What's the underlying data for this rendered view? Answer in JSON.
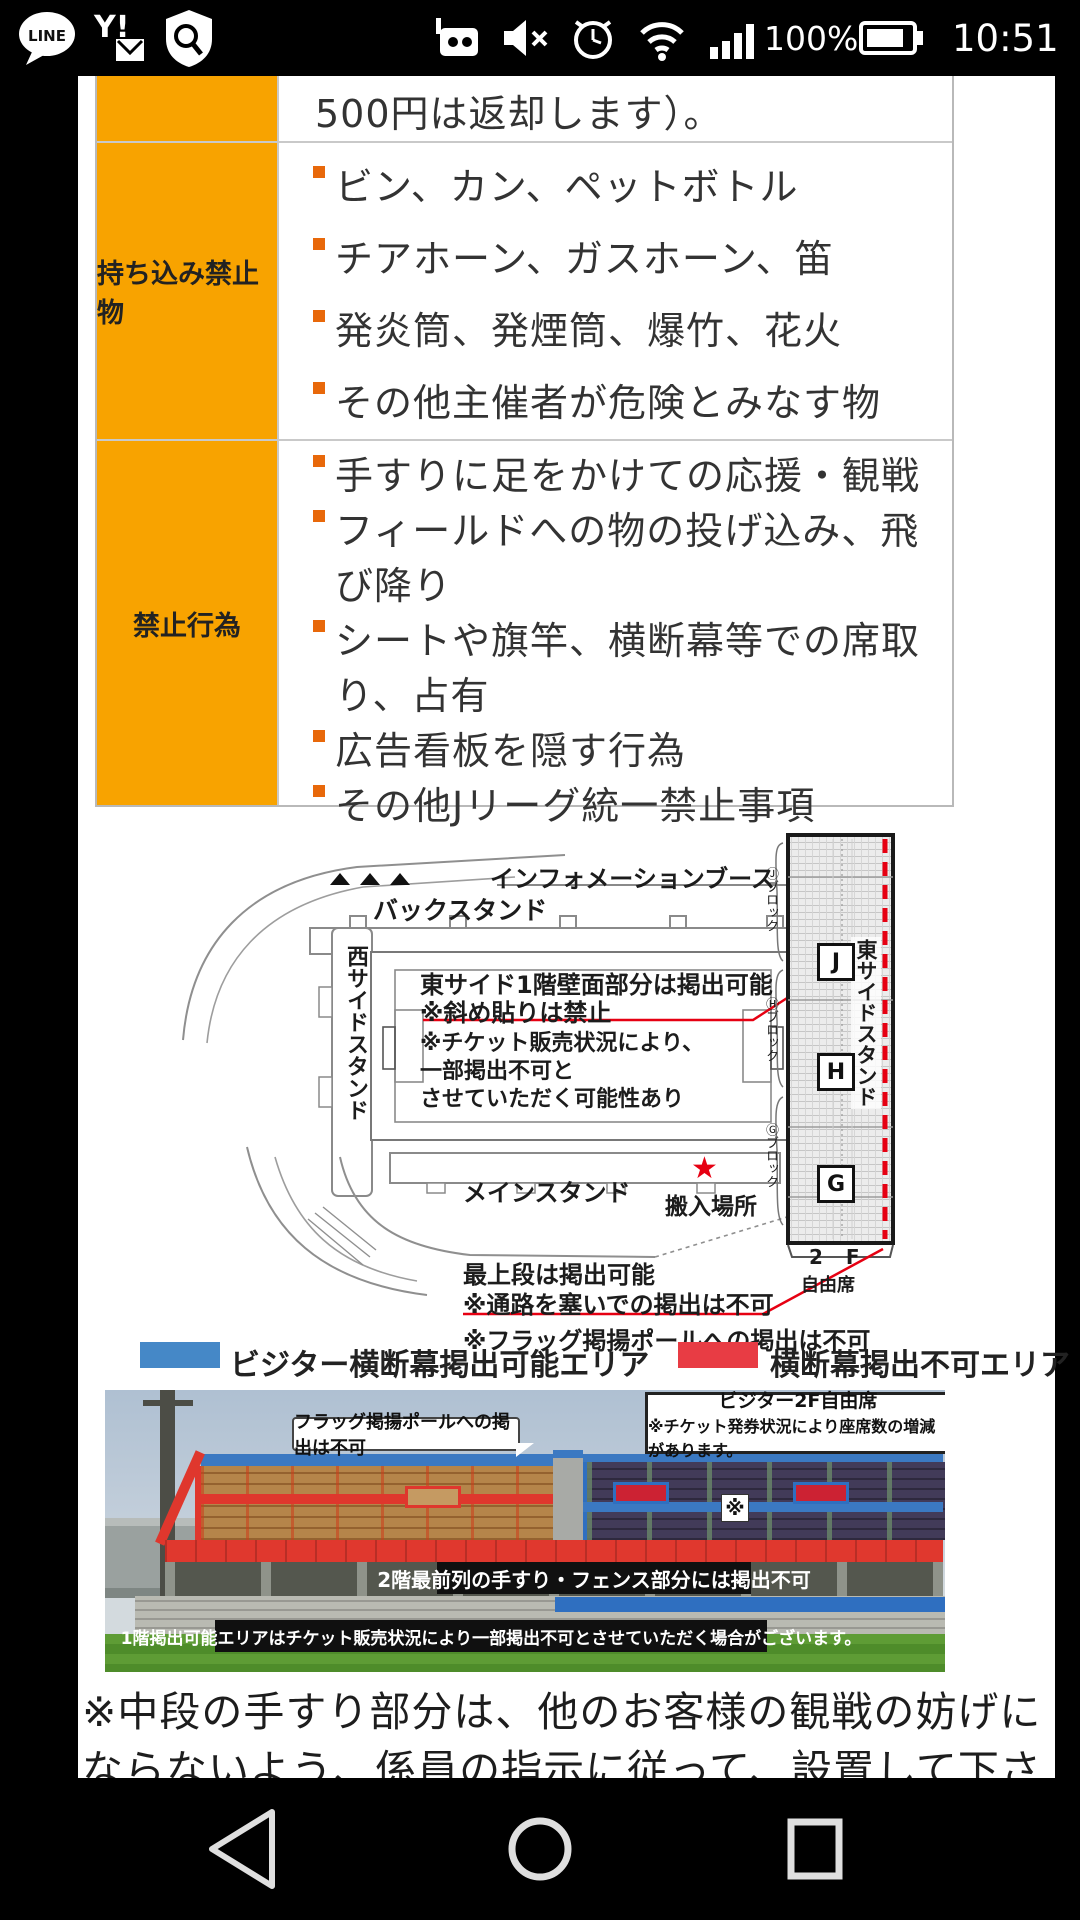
{
  "status_bar": {
    "time": "10:51",
    "battery_percent": "100%",
    "line_label": "LINE",
    "yahoo_label": "Y!"
  },
  "table": {
    "partial_row_text": "500円は返却します）。",
    "rows": [
      {
        "header": "持ち込み禁止物",
        "items": [
          "ビン、カン、ペットボトル",
          "チアホーン、ガスホーン、笛",
          "発炎筒、発煙筒、爆竹、花火",
          "その他主催者が危険とみなす物"
        ]
      },
      {
        "header": "禁止行為",
        "items": [
          "手すりに足をかけての応援・観戦",
          "フィールドへの物の投げ込み、飛び降り",
          "シートや旗竿、横断幕等での席取り、占有",
          "広告看板を隠す行為",
          "その他Jリーグ統一禁止事項"
        ]
      }
    ]
  },
  "map": {
    "info_booth": "インフォメーションブース",
    "back_stand": "バックスタンド",
    "west_stand": "西サイドスタンド",
    "east_stand": "東サイドスタンド",
    "main_stand": "メインスタンド",
    "carry_in_star": "★",
    "carry_in": "搬入場所",
    "note1_l1": "東サイド1階壁面部分は掲出可能",
    "note1_l2": "※斜め貼りは禁止",
    "note1_l3": "※チケット販売状況により、",
    "note1_l4": "一部掲出不可と",
    "note1_l5": "させていただく可能性あり",
    "note2_l1": "最上段は掲出可能",
    "note2_l2": "※通路を塞いでの掲出は不可",
    "note3": "※フラッグ掲揚ポールへの掲出は不可",
    "block_j": "J",
    "block_h": "H",
    "block_g": "G",
    "block_j_label": "Ⓙブロック",
    "block_h_label": "Ⓗブロック",
    "block_g_label": "Ⓖブロック",
    "floor": "2 F",
    "free_seat": "自由席"
  },
  "legend": {
    "allowed_label": "ビジター横断幕掲出可能エリア",
    "banned_label": "横断幕掲出不可エリア",
    "allowed_color": "#4588c7",
    "banned_color": "#e83c44"
  },
  "photo": {
    "callout_pole": "フラッグ掲揚ポールへの掲出は不可",
    "box_2f_line1": "ビジター2F自由席",
    "box_2f_line2": "※チケット発券状況により座席数の増減があります。",
    "note_mark": "※",
    "box_rail": "2階最前列の手すり・フェンス部分には掲出不可",
    "box_1f": "1階掲出可能エリアはチケット販売状況により一部掲出不可とさせていただく場合がございます。"
  },
  "footer_note": "※中段の手すり部分は、他のお客様の観戦の妨げにならないよう、係員の指示に従って、設置して下さい。"
}
